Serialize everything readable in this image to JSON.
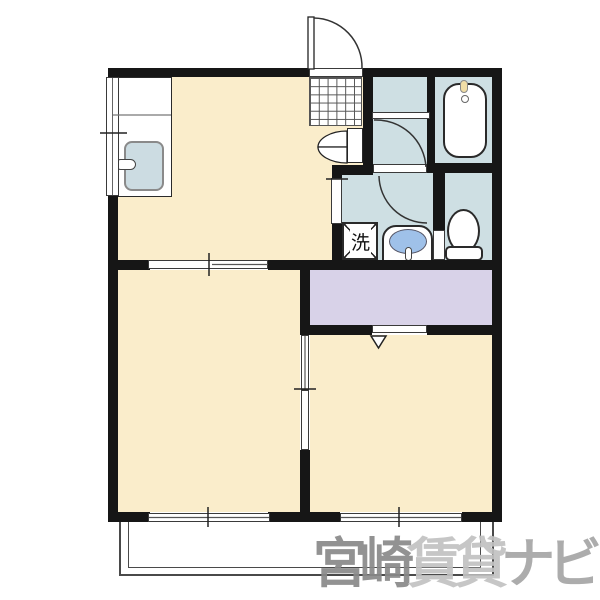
{
  "floorplan": {
    "type": "apartment-floor-plan",
    "washing_machine_label": "洗",
    "watermark": {
      "primary": "宮崎",
      "secondary": "賃貸",
      "tertiary": "ナビ"
    },
    "colors": {
      "floor_cream": "#FAEDCB",
      "wet_area_blue": "#CEDFE3",
      "closet_lavender": "#D8D2E8",
      "basin_bowl_blue": "#9FC1E9",
      "kitchen_sink_blue": "#CCDCE2",
      "faucet_yellow": "#F0DDA6",
      "wall_black": "#161616",
      "watermark_dark": "#898989",
      "watermark_light": "#C2C2C2",
      "watermark_mid": "#A6A6A6"
    }
  }
}
